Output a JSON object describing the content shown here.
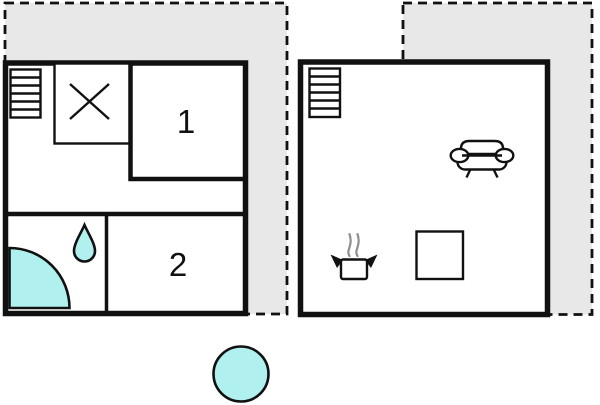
{
  "page": {
    "background": "#ffffff",
    "description_label": "floor plan"
  },
  "colors": {
    "terrace_fill": "#e8e8e8",
    "wall": "#111111",
    "water_fill": "#b0f1f0",
    "steam": "#8f8f8f",
    "background": "#ffffff"
  },
  "floorplan": {
    "rooms": {
      "room1_label": "1",
      "room2_label": "2"
    },
    "icons": {
      "terrace_left": "terrace-area",
      "terrace_right": "terrace-area",
      "window_left": "window-stripes-icon",
      "window_right": "window-stripes-icon",
      "wardrobe": "crossed-box-icon",
      "shower": "quarter-circle-shower-icon",
      "water_drop": "water-drop-icon",
      "sofa": "sofa-icon",
      "stove": "steaming-pot-icon",
      "table": "square-table-icon",
      "pool": "round-pool-icon"
    }
  }
}
